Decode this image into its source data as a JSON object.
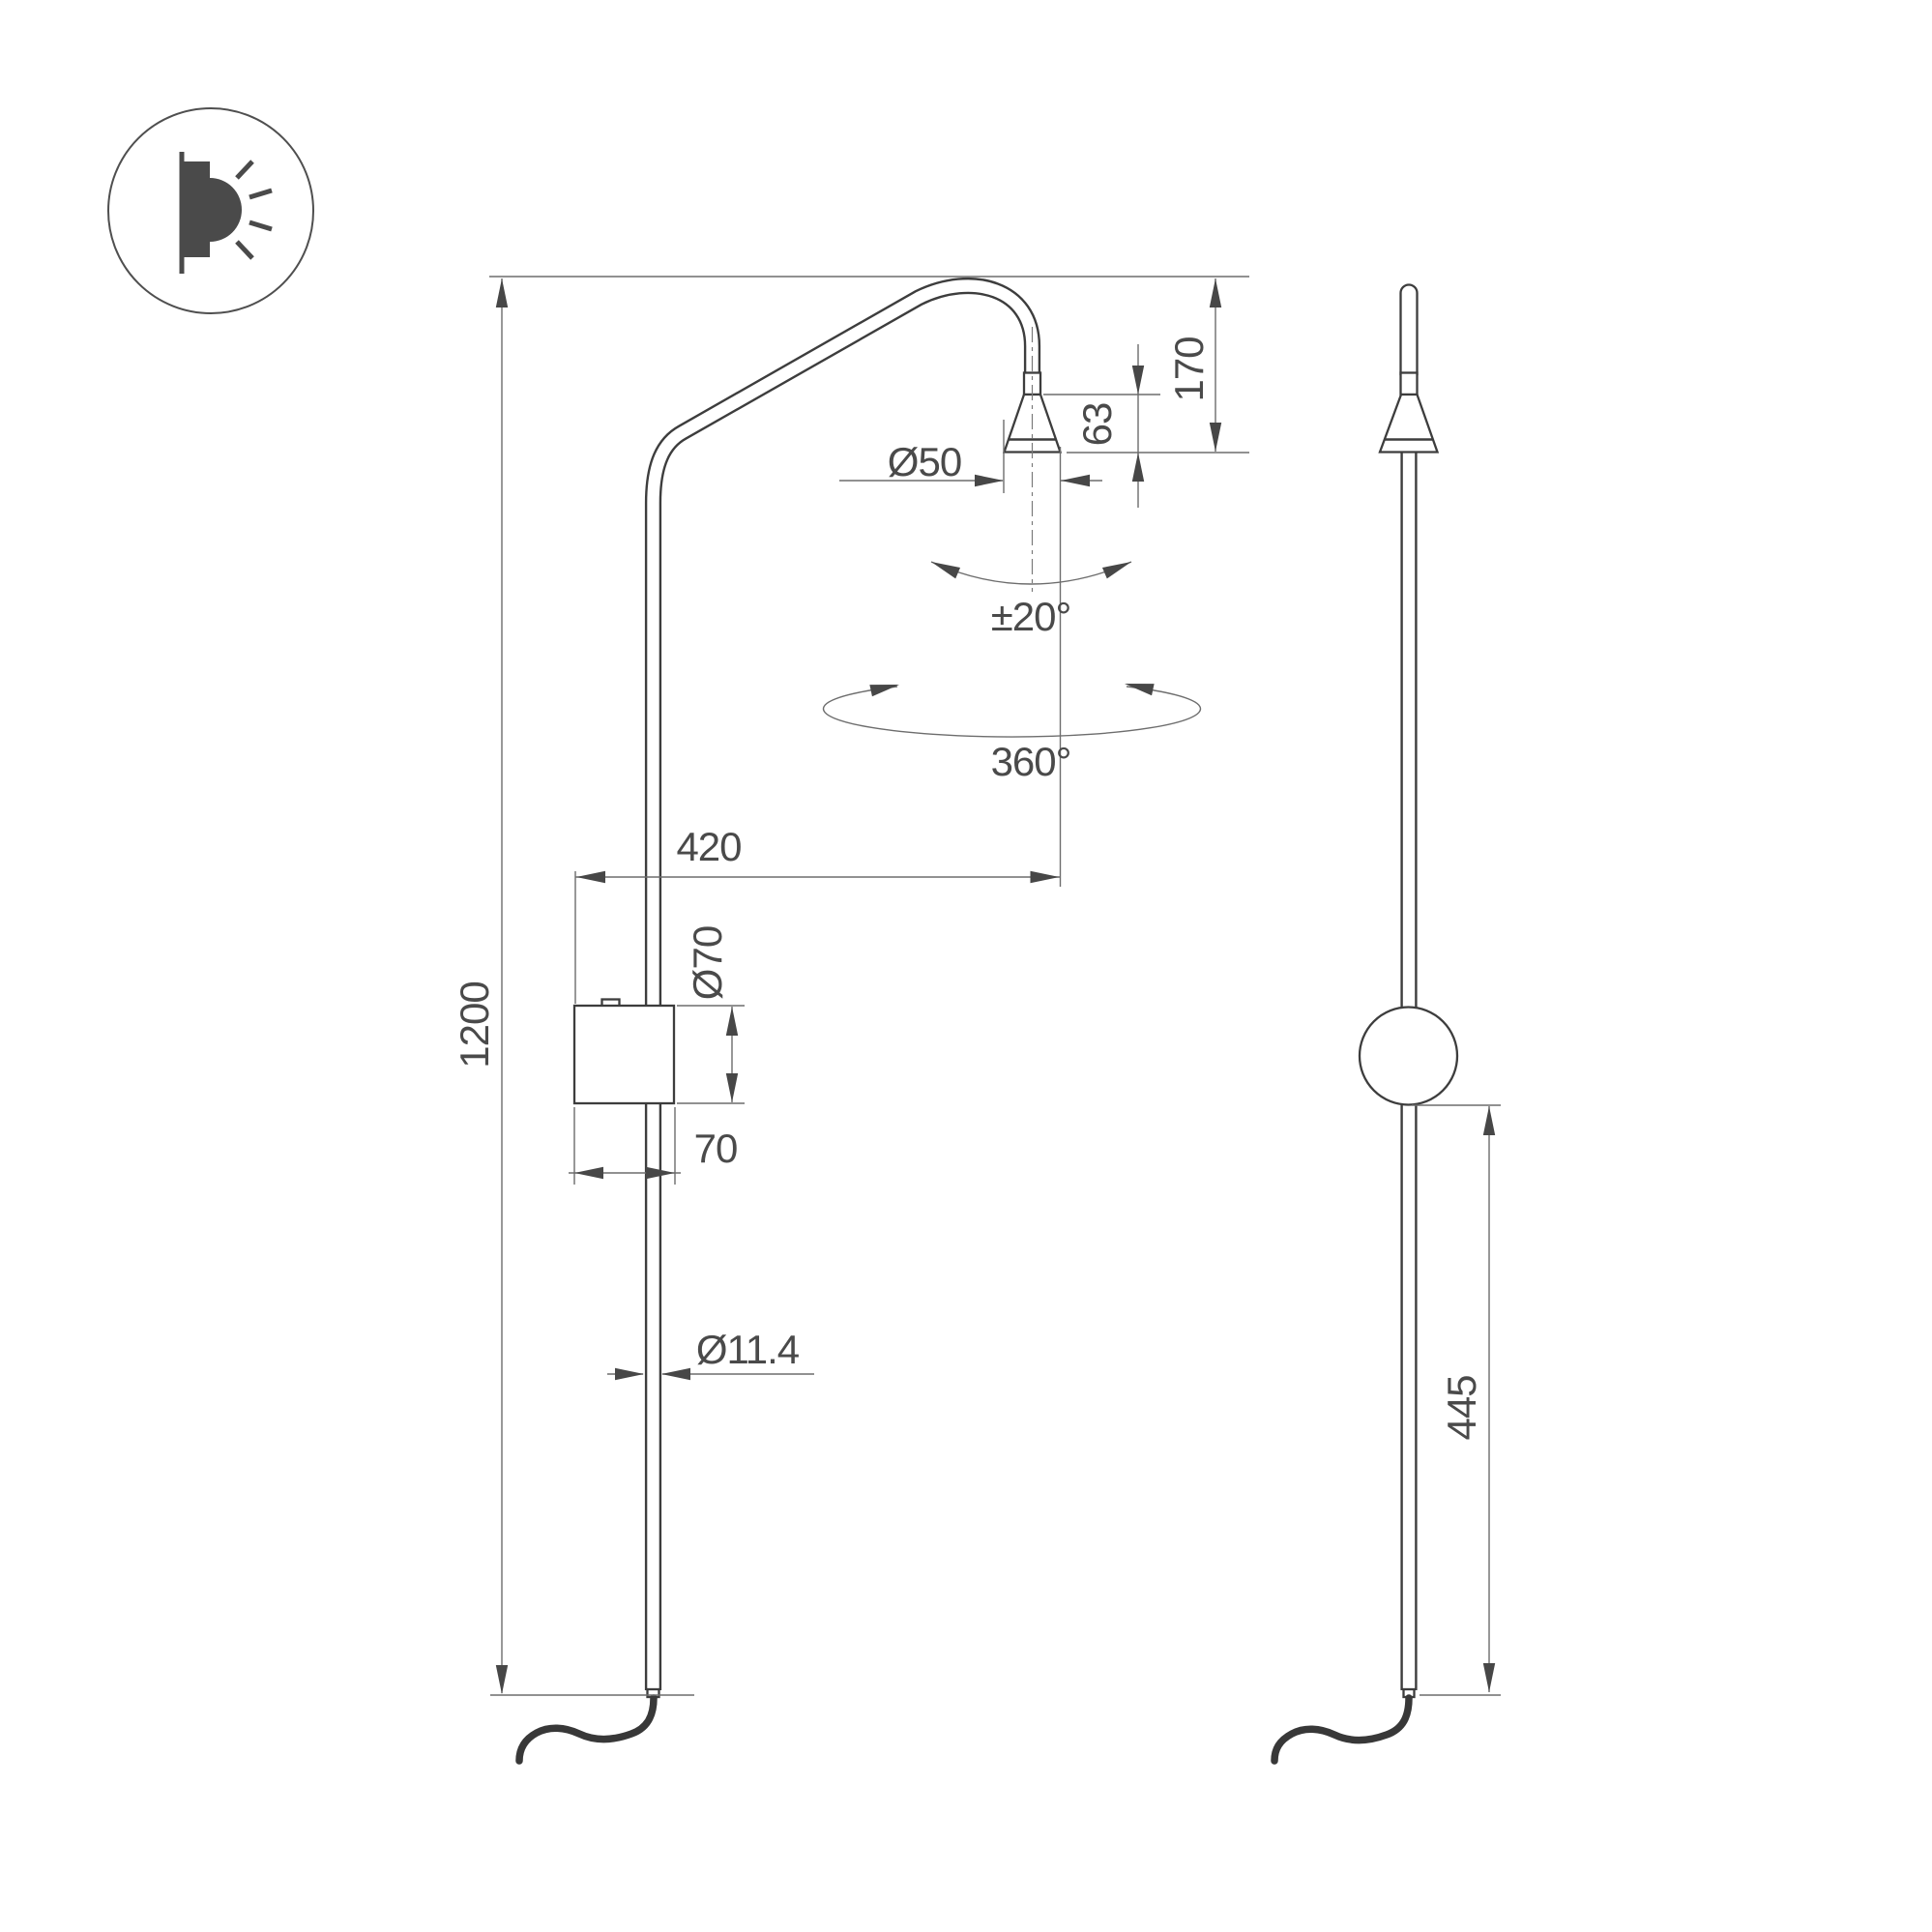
{
  "drawing": {
    "type": "technical-dimension-drawing",
    "subject": "wall-lamp-two-views",
    "colors": {
      "background": "#ffffff",
      "object_line": "#3d3d3d",
      "dimension_line": "#6d6d6d",
      "text": "#4a4a4a"
    },
    "icon": {
      "name": "wall-light-icon"
    },
    "labels": {
      "height_total": "1200",
      "arm_reach": "420",
      "head_height": "170",
      "cone_height": "63",
      "head_diameter": "Ø50",
      "tilt_angle": "±20°",
      "rotation_angle": "360°",
      "box_diameter": "Ø70",
      "box_width": "70",
      "rod_diameter": "Ø11.4",
      "ball_offset": "445"
    }
  }
}
